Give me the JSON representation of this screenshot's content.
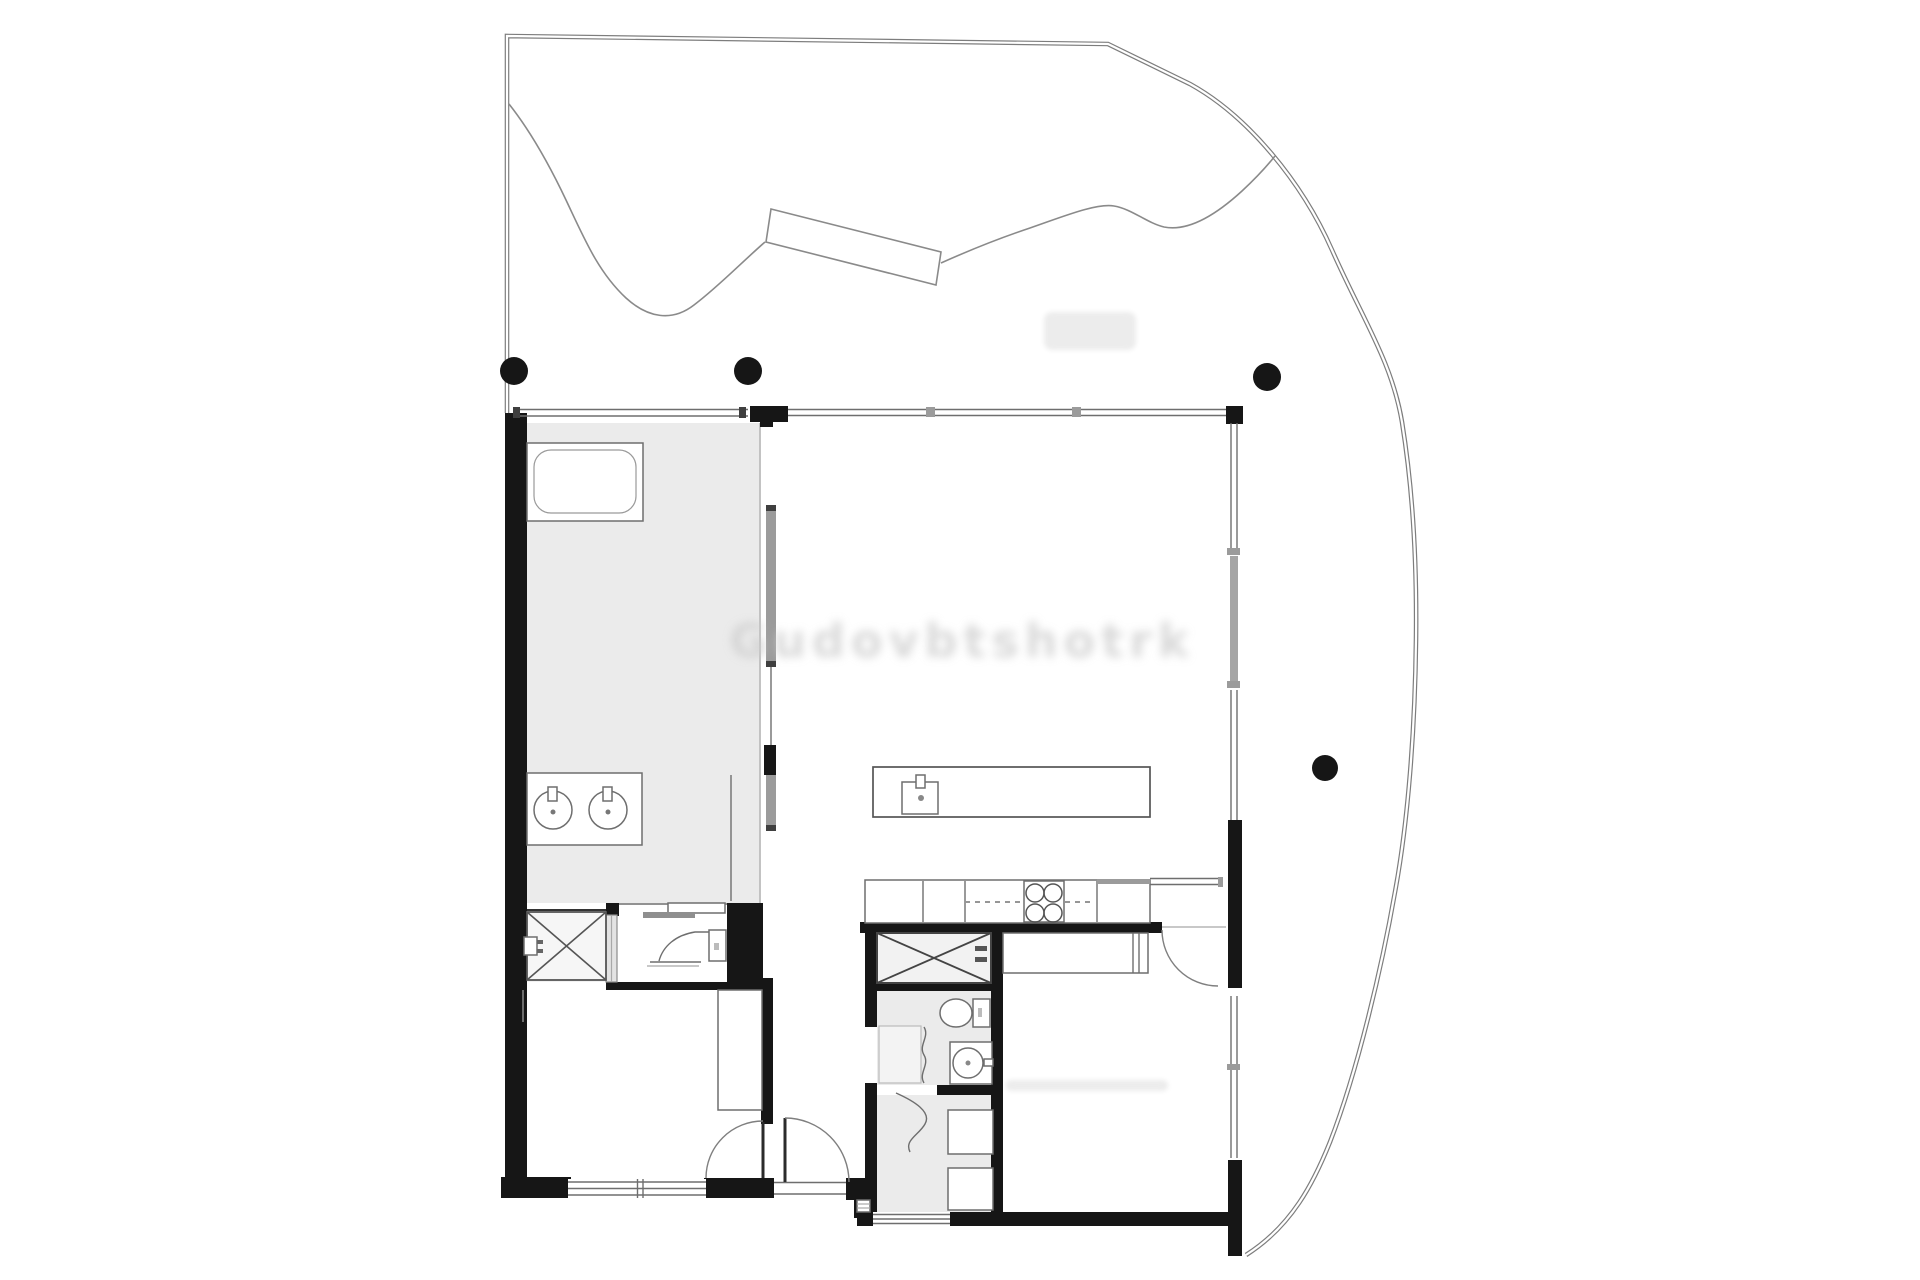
{
  "palette": {
    "background": "#ffffff",
    "wall": "#161616",
    "floor_tint": "#ebebeb",
    "floor_tint_light": "#f2f2f2",
    "line": "#6e6e6e",
    "boundary": "#7d7d7d",
    "door_panel": "#9b9b9b",
    "watermark": "#cccccc",
    "artifact": "#ececec"
  },
  "watermark": {
    "text": "Gudovbtshotrk"
  },
  "columns": {
    "count": 5
  }
}
